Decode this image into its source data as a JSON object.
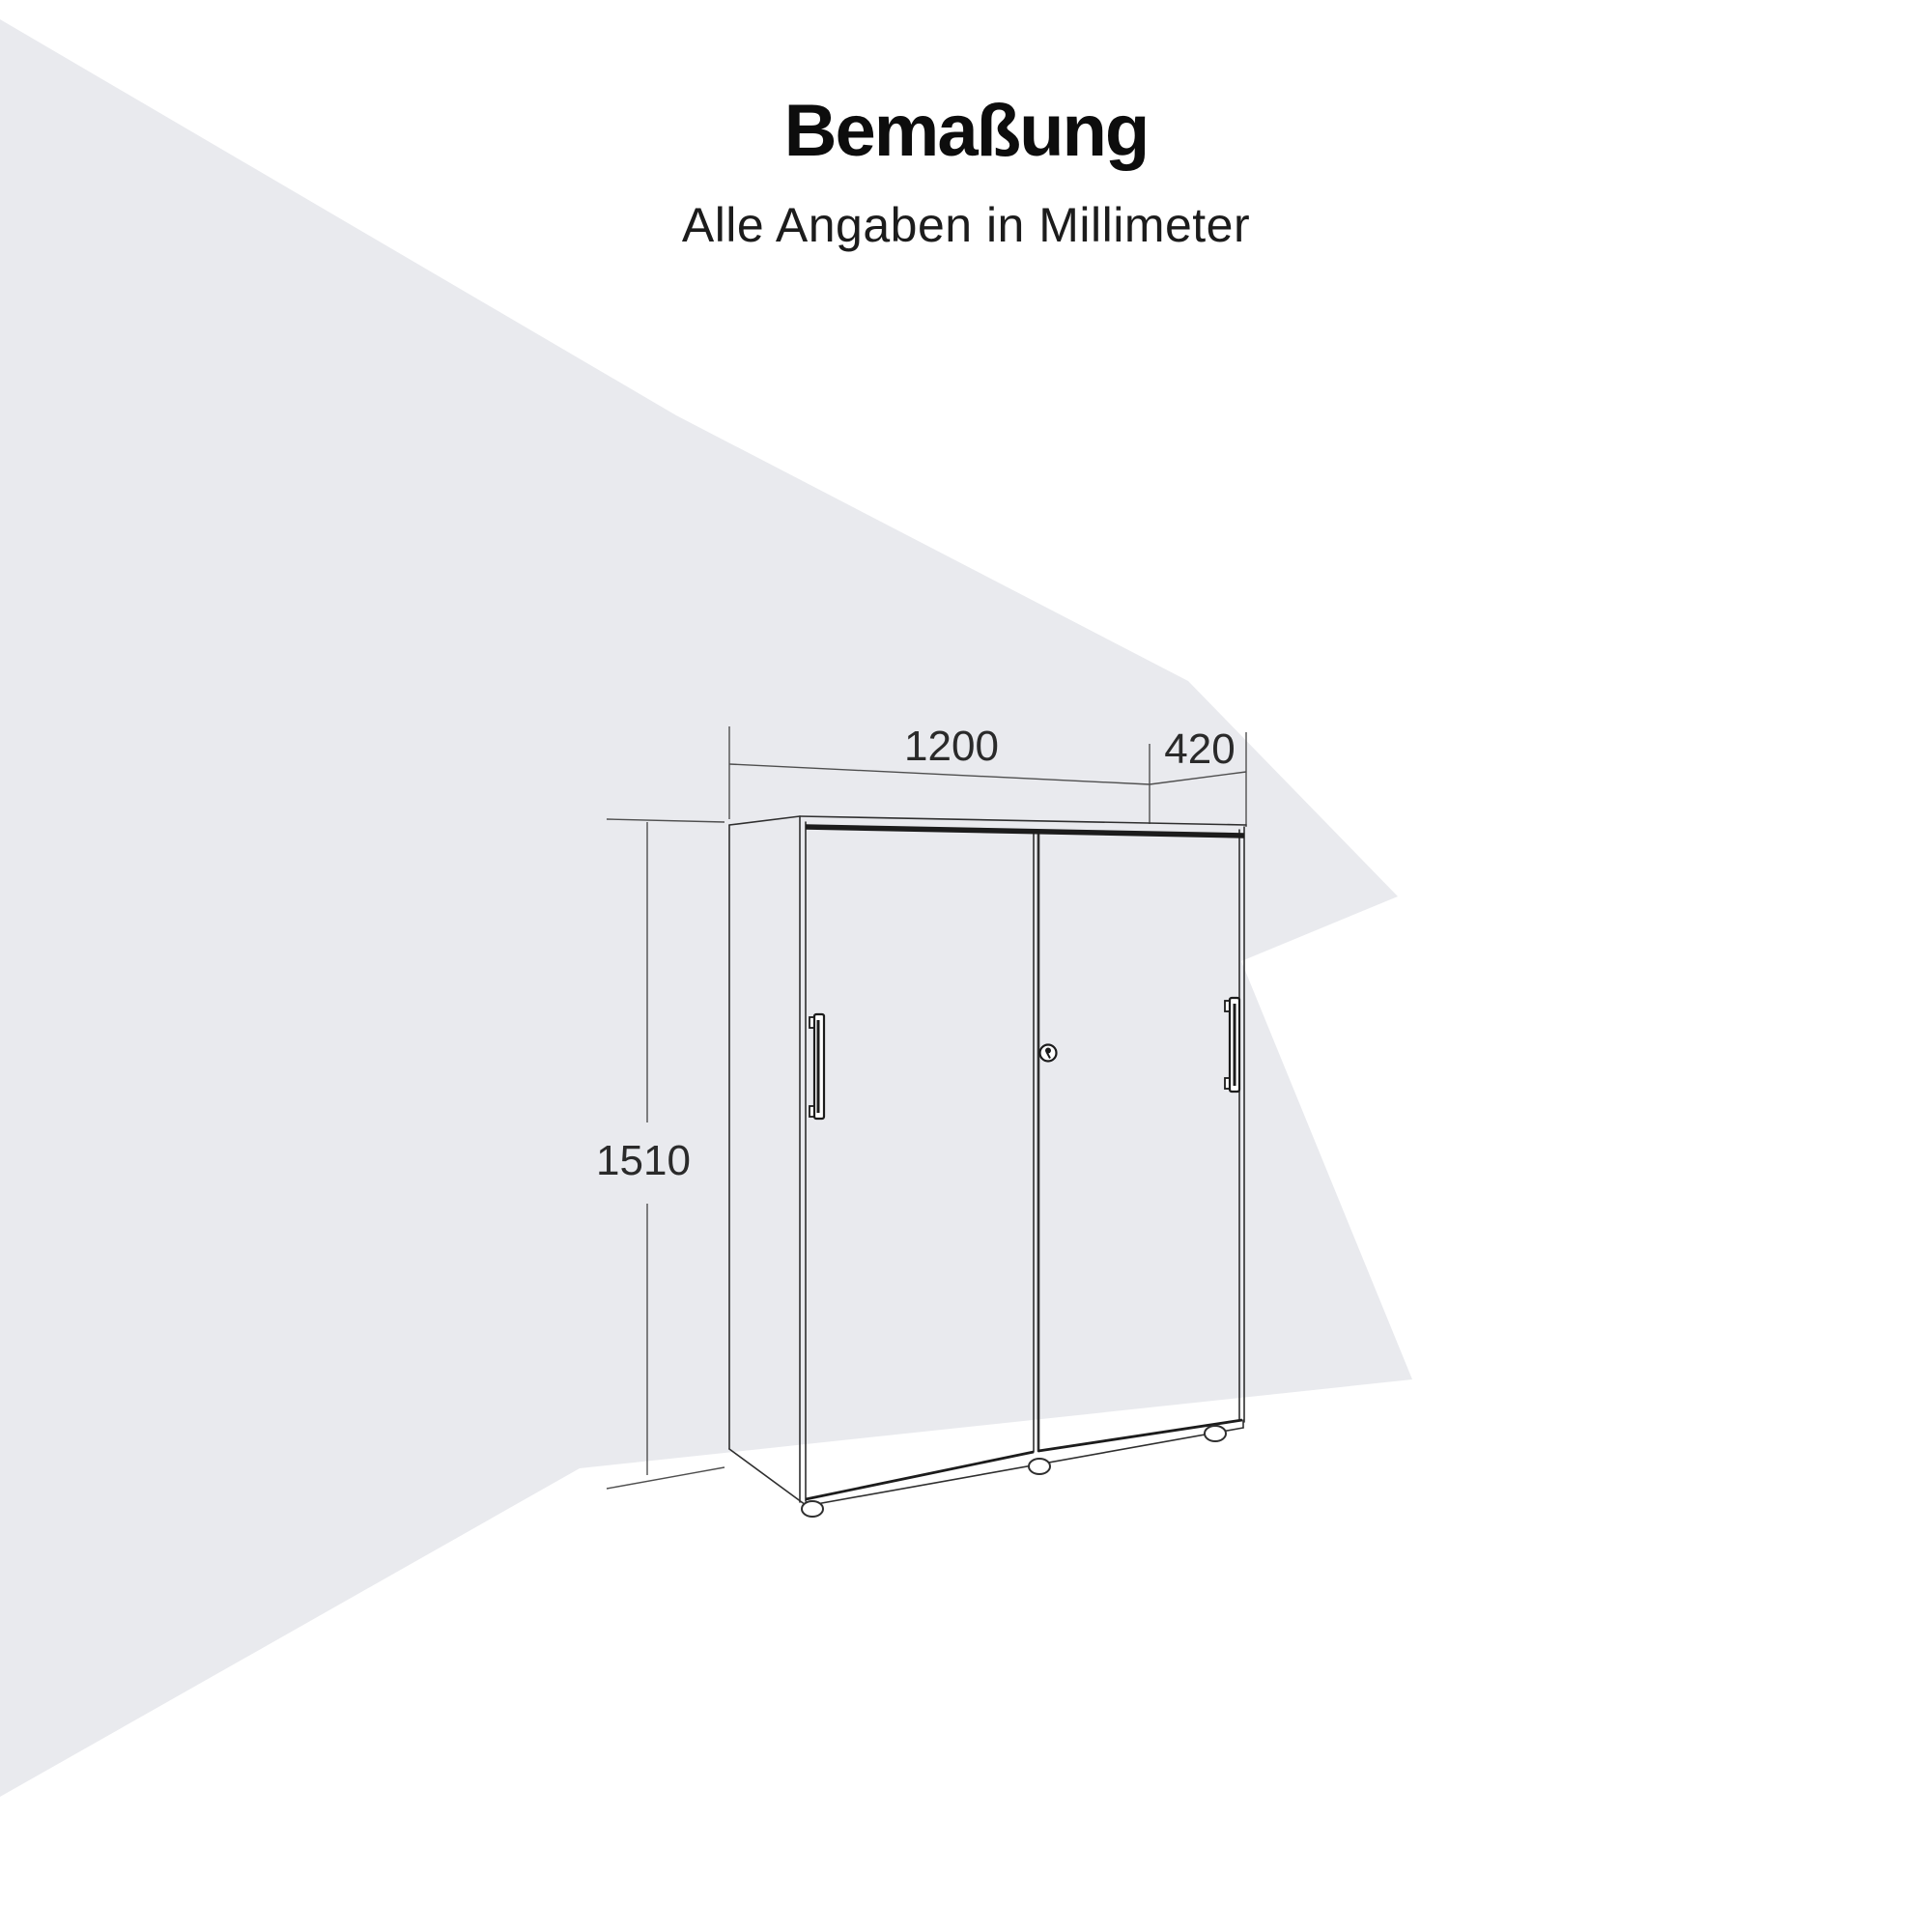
{
  "page": {
    "title": "Bemaßung",
    "subtitle": "Alle Angaben in Millimeter"
  },
  "dimensions": {
    "width_mm": "1200",
    "depth_mm": "420",
    "height_mm": "1510",
    "unit": "Millimeter"
  },
  "drawing": {
    "subject": "sliding-door-cabinet-front-view",
    "parts": [
      "left-sliding-door",
      "right-sliding-door",
      "left-door-handle",
      "right-door-handle",
      "cylinder-lock",
      "adjustable-feet"
    ]
  },
  "colors": {
    "background": "#ffffff",
    "wedge": "#e9eaee",
    "cabinet_line": "#2f2f2f",
    "dark_band": "#1c1c1c",
    "dimension_line": "#4f4f4f",
    "text": "#111111"
  }
}
